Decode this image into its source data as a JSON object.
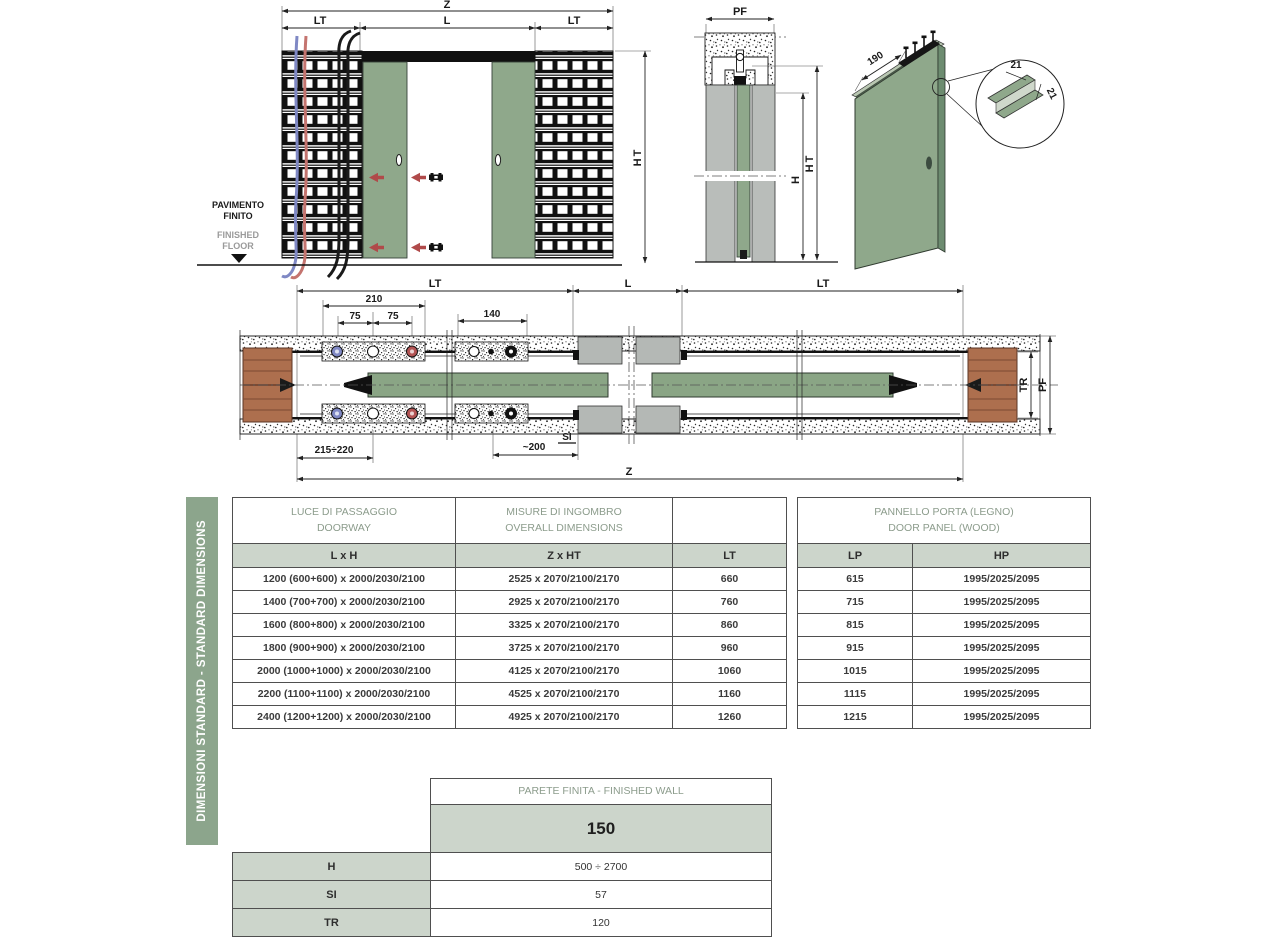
{
  "labels": {
    "z": "Z",
    "lt": "LT",
    "l": "L",
    "h": "H",
    "ht": "HT",
    "pf": "PF",
    "tr": "TR",
    "si": "SI",
    "pavimento_line1": "PAVIMENTO",
    "pavimento_line2": "FINITO",
    "finished_line1": "FINISHED",
    "finished_line2": "FLOOR",
    "d190": "190",
    "d21": "21",
    "d210": "210",
    "d75": "75",
    "d140": "140",
    "d215_220": "215÷220",
    "d200": "~200"
  },
  "sidebar": {
    "label": "DIMENSIONI STANDARD - STANDARD DIMENSIONS"
  },
  "main_table": {
    "group1_line1": "LUCE DI PASSAGGIO",
    "group1_line2": "DOORWAY",
    "group2_line1": "MISURE DI INGOMBRO",
    "group2_line2": "OVERALL DIMENSIONS",
    "columns": [
      "L x H",
      "Z x HT",
      "LT"
    ],
    "rows": [
      [
        "1200 (600+600) x 2000/2030/2100",
        "2525 x 2070/2100/2170",
        "660"
      ],
      [
        "1400 (700+700) x 2000/2030/2100",
        "2925 x 2070/2100/2170",
        "760"
      ],
      [
        "1600 (800+800) x 2000/2030/2100",
        "3325 x 2070/2100/2170",
        "860"
      ],
      [
        "1800 (900+900) x 2000/2030/2100",
        "3725 x 2070/2100/2170",
        "960"
      ],
      [
        "2000 (1000+1000) x 2000/2030/2100",
        "4125 x 2070/2100/2170",
        "1060"
      ],
      [
        "2200 (1100+1100) x 2000/2030/2100",
        "4525 x 2070/2100/2170",
        "1160"
      ],
      [
        "2400 (1200+1200) x 2000/2030/2100",
        "4925 x 2070/2100/2170",
        "1260"
      ]
    ]
  },
  "panel_table": {
    "header_line1": "PANNELLO PORTA (LEGNO)",
    "header_line2": "DOOR PANEL (WOOD)",
    "columns": [
      "LP",
      "HP"
    ],
    "rows": [
      [
        "615",
        "1995/2025/2095"
      ],
      [
        "715",
        "1995/2025/2095"
      ],
      [
        "815",
        "1995/2025/2095"
      ],
      [
        "915",
        "1995/2025/2095"
      ],
      [
        "1015",
        "1995/2025/2095"
      ],
      [
        "1115",
        "1995/2025/2095"
      ],
      [
        "1215",
        "1995/2025/2095"
      ]
    ]
  },
  "wall_table": {
    "header": "PARETE FINITA - FINISHED WALL",
    "size_value": "150",
    "rows": [
      {
        "label": "H",
        "value": "500 ÷ 2700"
      },
      {
        "label": "SI",
        "value": "57"
      },
      {
        "label": "TR",
        "value": "120"
      }
    ]
  },
  "colors": {
    "door_green": "#8fa88b",
    "sidebar_green": "#8ca58c",
    "header_text_green": "#8c9c8c",
    "subheader_bg": "#ccd5cb",
    "jamb_brown": "#ad6f4e",
    "wall_gray": "#b9bdba",
    "arrow_red": "#b04a4a",
    "cable_blue": "#7f88c4",
    "cable_red": "#c4746f"
  }
}
